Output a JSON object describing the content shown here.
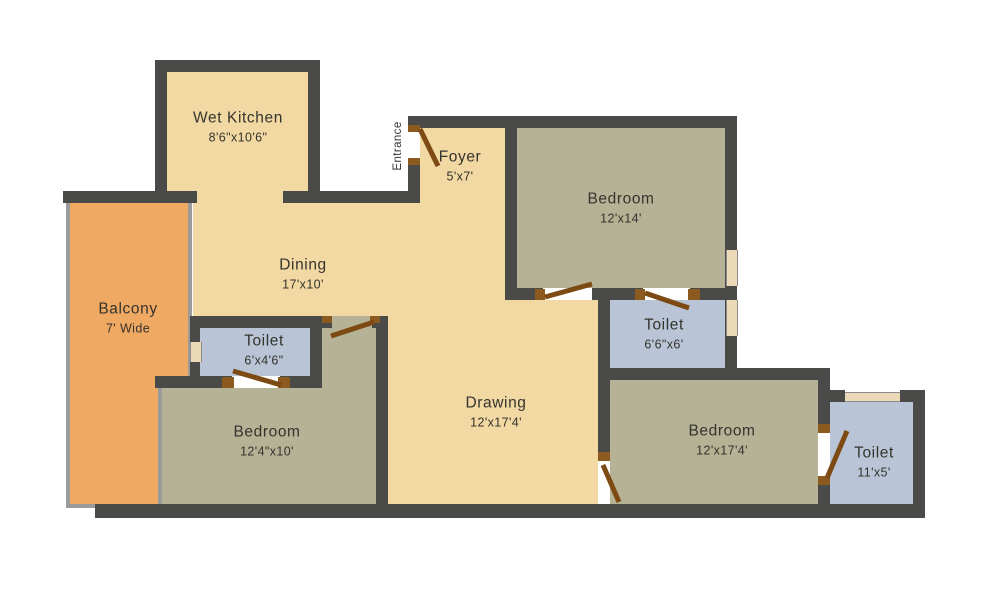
{
  "title": "Apartment Floor Plan",
  "entrance": {
    "label": "Entrance"
  },
  "palette": {
    "wall": "#4a4a49",
    "floor_living": "#f2d8a2",
    "floor_bedroom": "#b5b295",
    "floor_toilet": "#b9c5d6",
    "floor_balcony": "#efa963",
    "door_swing": "#7c4a12",
    "window": "#ecd9b8",
    "railing": "#9b9b9b",
    "text": "#34332e",
    "background": "#ffffff"
  },
  "rooms": [
    {
      "name": "Wet Kitchen",
      "dims": "8'6\"x10'6\""
    },
    {
      "name": "Foyer",
      "dims": "5'x7'"
    },
    {
      "name": "Bedroom",
      "dims": "12'x14'"
    },
    {
      "name": "Dining",
      "dims": "17'x10'"
    },
    {
      "name": "Balcony",
      "dims": "7' Wide"
    },
    {
      "name": "Toilet",
      "dims": "6'x4'6\""
    },
    {
      "name": "Toilet",
      "dims": "6'6\"x6'"
    },
    {
      "name": "Drawing",
      "dims": "12'x17'4'"
    },
    {
      "name": "Bedroom",
      "dims": "12'4\"x10'"
    },
    {
      "name": "Bedroom",
      "dims": "12'x17'4'"
    },
    {
      "name": "Toilet",
      "dims": "11'x5'"
    }
  ]
}
